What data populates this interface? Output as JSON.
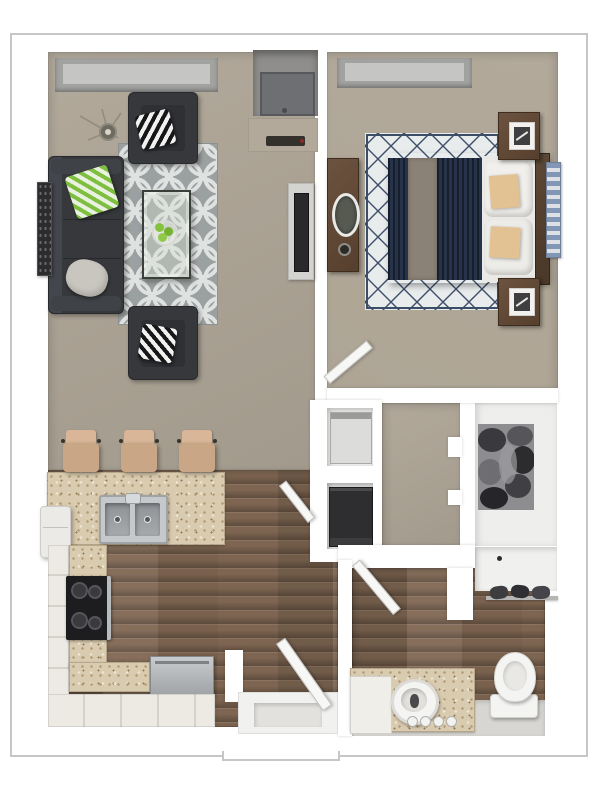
{
  "page": {
    "description": "3D top-down rendering of a one-bedroom, one-bathroom apartment floor plan",
    "visible_text": ""
  },
  "colors": {
    "page_bg": "#ffffff",
    "border": "#c6c6c4",
    "wall": "#ffffff",
    "carpet": "#b2a99b",
    "carpet_dark": "#a29a8c",
    "wood": "#7e6551",
    "wood_furniture": "#6b5340",
    "granite": "#d9cbb0",
    "granite_fleck": "#b39c76",
    "tile": "#edeae4",
    "sofa": "#36383c",
    "rug_gray": "#9ba1a0",
    "rug_line": "#e0e3e1",
    "bed_rug": "#e9eced",
    "navy": "#26334a",
    "runner": "#8b8277",
    "sheets": "#eae9e5",
    "tan_pillow": "#e2c193",
    "green_pillow": "#7fbf3f",
    "stool": "#c9a685",
    "stool_light": "#d8b697",
    "stainless_hex": "#b7babd",
    "appliance_dark": "#2e2e30",
    "white_fixture": "#f4f4f2",
    "closet_floor": "#eeeeec",
    "bath_tile": "#d8d6d2",
    "window_recess": "#a2a2a0",
    "door": "#f7f7f5"
  },
  "rooms": [
    {
      "id": "living-room",
      "floor": "carpet",
      "contents": [
        "window",
        "sofa-charcoal",
        "accent-chair-top",
        "accent-chair-bottom",
        "zebra-pillows",
        "green-chevron-pillow",
        "gray-pillow",
        "trellis-area-rug",
        "glass-coffee-table",
        "green-apples-decor",
        "branch-decor",
        "wall-art",
        "tv-with-console",
        "media-alcove",
        "media-shelf"
      ]
    },
    {
      "id": "bedroom",
      "floor": "carpet",
      "contents": [
        "window",
        "queen-bed-navy",
        "taupe-bed-runner",
        "white-pillows",
        "tan-accent-pillows",
        "headboard",
        "nightstand-top",
        "nightstand-bottom",
        "picture-frames",
        "dresser-with-oval-mirror",
        "diamond-lattice-rug",
        "blue-wall-decor",
        "door"
      ]
    },
    {
      "id": "kitchen",
      "floor": "hardwood",
      "contents": [
        "breakfast-bar-granite",
        "bar-stool-1",
        "bar-stool-2",
        "bar-stool-3",
        "double-stainless-sink",
        "faucet",
        "refrigerator",
        "black-cooktop-range",
        "dishwasher-stainless",
        "l-shaped-tile-counter"
      ]
    },
    {
      "id": "hallway",
      "floor": "carpet",
      "contents": [
        "utility-closet-white-appliance",
        "utility-closet-dark-appliance",
        "utility-closet-door"
      ]
    },
    {
      "id": "walk-in-closet",
      "floor": "light",
      "contents": [
        "hanging-clothes"
      ]
    },
    {
      "id": "bathroom",
      "floor": "hardwood-and-tile",
      "contents": [
        "vanity-granite-counter",
        "vessel-sink",
        "vanity-cabinet",
        "drawer-knobs",
        "toilet",
        "towel-bar",
        "shower-nook-with-drain",
        "door"
      ]
    },
    {
      "id": "entry",
      "floor": "hardwood",
      "contents": [
        "entry-door",
        "threshold-step"
      ]
    }
  ]
}
